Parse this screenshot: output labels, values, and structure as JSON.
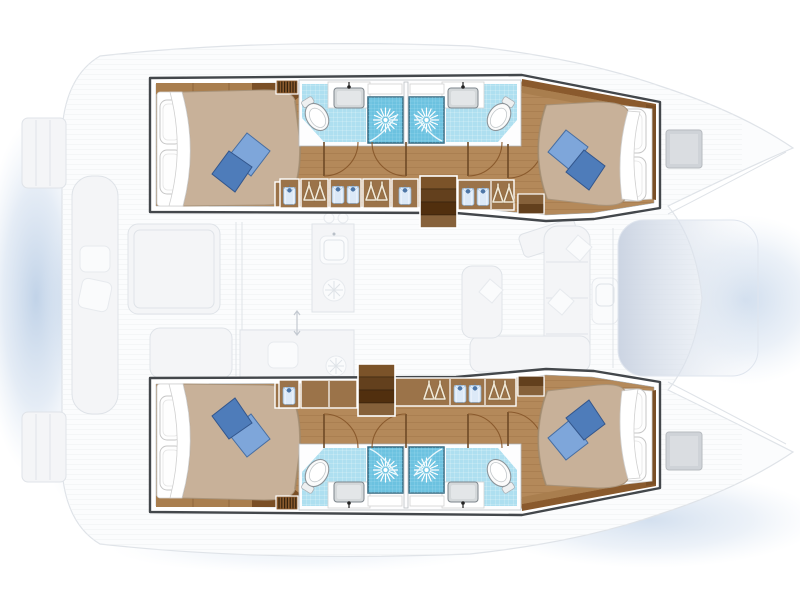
{
  "diagram": {
    "kind": "catamaran-yacht-deck-plan",
    "orientation": "bow-right",
    "summary": {
      "cabins": 4,
      "double_berths": 4,
      "heads": 4,
      "showers": 4,
      "companionway_stairs": 2,
      "deck_hatches": 2
    },
    "hulls": [
      {
        "id": "port-hull",
        "position": "top",
        "rooms": [
          {
            "name": "aft-cabin",
            "features": [
              "double-berth-icon",
              "white-pillows",
              "blue-throw-pillows",
              "vent-grille-icon",
              "shirt-locker-icon"
            ]
          },
          {
            "name": "aft-head",
            "fixtures": [
              "toilet-icon",
              "washbasin-icon",
              "shower-icon"
            ]
          },
          {
            "name": "forward-head",
            "fixtures": [
              "toilet-icon",
              "washbasin-icon",
              "shower-icon"
            ]
          },
          {
            "name": "companionway",
            "features": [
              "stairs-icon",
              "wardrobe-hangers-icon",
              "wardrobe-shirts-icon",
              "door-swing-arcs",
              "vent-grille-icon"
            ]
          },
          {
            "name": "forward-cabin",
            "features": [
              "double-berth-icon",
              "white-pillows",
              "blue-throw-pillows",
              "entry-steps-icon"
            ]
          }
        ]
      },
      {
        "id": "starboard-hull",
        "position": "bottom",
        "rooms": [
          {
            "name": "aft-cabin",
            "features": [
              "double-berth-icon",
              "white-pillows",
              "blue-throw-pillows",
              "vent-grille-icon",
              "shirt-locker-icon"
            ]
          },
          {
            "name": "aft-head",
            "fixtures": [
              "toilet-icon",
              "washbasin-icon",
              "shower-icon"
            ]
          },
          {
            "name": "forward-head",
            "fixtures": [
              "toilet-icon",
              "washbasin-icon",
              "shower-icon"
            ]
          },
          {
            "name": "companionway",
            "features": [
              "stairs-icon",
              "plain-locker",
              "wardrobe-hangers-icon",
              "wardrobe-shirts-icon",
              "door-swing-arcs",
              "vent-grille-icon"
            ]
          },
          {
            "name": "forward-cabin",
            "features": [
              "double-berth-icon",
              "white-pillows",
              "blue-throw-pillows",
              "entry-steps-icon"
            ]
          }
        ]
      }
    ],
    "bridge_deck_ghost": {
      "areas": [
        "aft-cockpit",
        "saloon",
        "galley",
        "foredeck",
        "coachroof"
      ],
      "features": [
        "cockpit-bench",
        "cockpit-table",
        "cockpit-seat",
        "transom-steps",
        "galley-sink-icon",
        "stove-burners-icon",
        "galley-counter",
        "saloon-sofa",
        "saloon-chaise",
        "saloon-table",
        "ghost-cushions",
        "deck-hatch-icon",
        "sliding-door-arrow"
      ]
    }
  },
  "colors": {
    "water": "#b6cbe4",
    "wall": "#ffffff",
    "outline": "#43474b",
    "ghost_fill": "#f4f5f7",
    "ghost_line": "#dfe3e8",
    "coachroof": "#c9d2e1",
    "wood_floor": "#b4895a",
    "wood_plank_line": "#a3774a",
    "wood_cabinet": "#9b7349",
    "wood_mid": "#a97e4e",
    "wood_dark": "#7a4f26",
    "stair_dark": "#512f0e",
    "duvet_beige": "#c8b199",
    "pillow_white": "#fefefe",
    "pillow_blue_light": "#7ea6da",
    "pillow_blue_dark": "#4e7cba",
    "tile_floor": "#aedff0",
    "tile_shower": "#6cc2e0",
    "shower_border": "#33677f",
    "fixture_stroke": "#8d9499",
    "sink_gray": "#d4d8da",
    "shirt_blue": "#dce9f7",
    "hanger_cream": "#f2ead8"
  }
}
